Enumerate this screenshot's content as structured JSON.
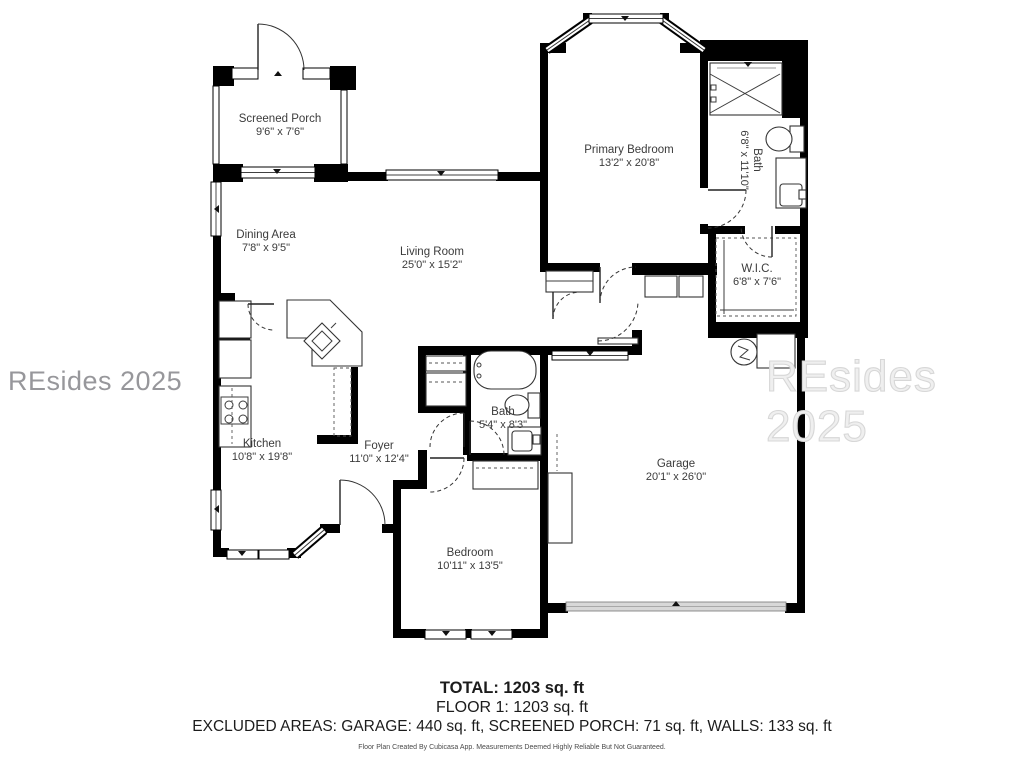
{
  "watermarks": {
    "left": "REsides 2025",
    "right": "REsides 2025"
  },
  "rooms": {
    "screened_porch": {
      "name": "Screened Porch",
      "dims": "9'6\" x 7'6\""
    },
    "dining": {
      "name": "Dining Area",
      "dims": "7'8\" x 9'5\""
    },
    "living": {
      "name": "Living Room",
      "dims": "25'0\" x 15'2\""
    },
    "primary": {
      "name": "Primary Bedroom",
      "dims": "13'2\" x 20'8\""
    },
    "bath1": {
      "name": "Bath",
      "dims": "6'8\" x 11'10\""
    },
    "wic": {
      "name": "W.I.C.",
      "dims": "6'8\" x 7'6\""
    },
    "kitchen": {
      "name": "Kitchen",
      "dims": "10'8\" x 19'8\""
    },
    "foyer": {
      "name": "Foyer",
      "dims": "11'0\" x 12'4\""
    },
    "bath2": {
      "name": "Bath",
      "dims": "5'4\" x 8'3\""
    },
    "bedroom": {
      "name": "Bedroom",
      "dims": "10'11\" x 13'5\""
    },
    "garage": {
      "name": "Garage",
      "dims": "20'1\" x 26'0\""
    }
  },
  "summary": {
    "total": "TOTAL: 1203 sq. ft",
    "floor": "FLOOR 1: 1203 sq. ft",
    "excluded": "EXCLUDED AREAS: GARAGE: 440 sq. ft, SCREENED PORCH: 71 sq. ft, WALLS: 133 sq. ft",
    "disclaimer": "Floor Plan Created By Cubicasa App. Measurements Deemed Highly Reliable But Not Guaranteed."
  },
  "fixtures": [
    "shower",
    "bathtub",
    "toilet",
    "sink",
    "stove",
    "kitchen-island-sink",
    "water-heater",
    "garage-door",
    "closet",
    "door-swing",
    "window"
  ],
  "colors": {
    "wall": "#000000",
    "watermark_left": "#97979b",
    "watermark_right": "#efefef",
    "garage_door": "#d8d8d8"
  }
}
